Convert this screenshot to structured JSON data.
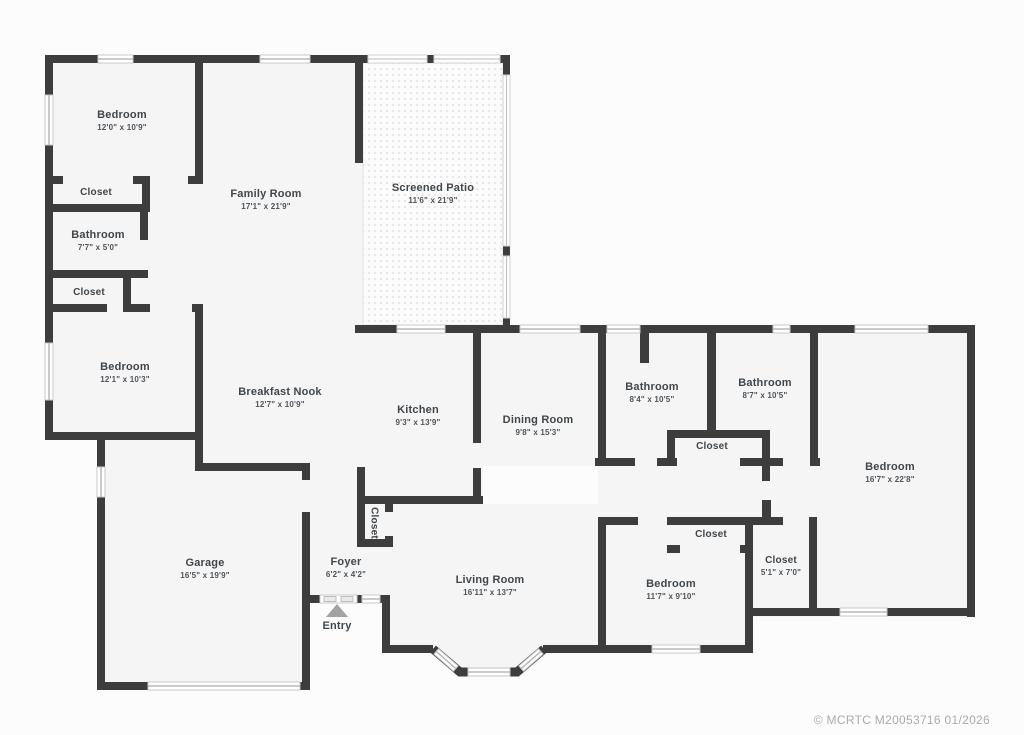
{
  "plan": {
    "title": "Single-story house floor plan",
    "watermark": "© MCRTC M20053716 01/2026",
    "rooms": [
      {
        "id": "bedroom-1",
        "name": "Bedroom",
        "dims": "12'0\" x 10'9\""
      },
      {
        "id": "closet-1",
        "name": "Closet"
      },
      {
        "id": "bathroom-small",
        "name": "Bathroom",
        "dims": "7'7\" x 5'0\""
      },
      {
        "id": "closet-2",
        "name": "Closet"
      },
      {
        "id": "bedroom-2",
        "name": "Bedroom",
        "dims": "12'1\" x 10'3\""
      },
      {
        "id": "family-room",
        "name": "Family Room",
        "dims": "17'1\" x 21'9\""
      },
      {
        "id": "screened-patio",
        "name": "Screened Patio",
        "dims": "11'6\" x 21'9\""
      },
      {
        "id": "breakfast-nook",
        "name": "Breakfast Nook",
        "dims": "12'7\" x 10'9\""
      },
      {
        "id": "kitchen",
        "name": "Kitchen",
        "dims": "9'3\" x 13'9\""
      },
      {
        "id": "dining-room",
        "name": "Dining Room",
        "dims": "9'8\" x 15'3\""
      },
      {
        "id": "bathroom-1",
        "name": "Bathroom",
        "dims": "8'4\" x 10'5\""
      },
      {
        "id": "bathroom-2",
        "name": "Bathroom",
        "dims": "8'7\" x 10'5\""
      },
      {
        "id": "closet-hall",
        "name": "Closet"
      },
      {
        "id": "bedroom-master",
        "name": "Bedroom",
        "dims": "16'7\" x 22'8\""
      },
      {
        "id": "garage",
        "name": "Garage",
        "dims": "16'5\" x 19'9\""
      },
      {
        "id": "foyer",
        "name": "Foyer",
        "dims": "6'2\" x 4'2\""
      },
      {
        "id": "closet-foyer",
        "name": "Closet"
      },
      {
        "id": "living-room",
        "name": "Living Room",
        "dims": "16'11\" x 13'7\""
      },
      {
        "id": "bedroom-4",
        "name": "Bedroom",
        "dims": "11'7\" x 9'10\""
      },
      {
        "id": "closet-bedroom4",
        "name": "Closet"
      },
      {
        "id": "closet-5",
        "name": "Closet",
        "dims": "5'1\" x 7'0\""
      },
      {
        "id": "entry",
        "name": "Entry"
      }
    ],
    "colors": {
      "wall": "#3d3d3d",
      "floor": "#f5f5f5",
      "window_line": "#b9b9b9",
      "label": "#40474c",
      "watermark": "#a7abb0"
    }
  }
}
